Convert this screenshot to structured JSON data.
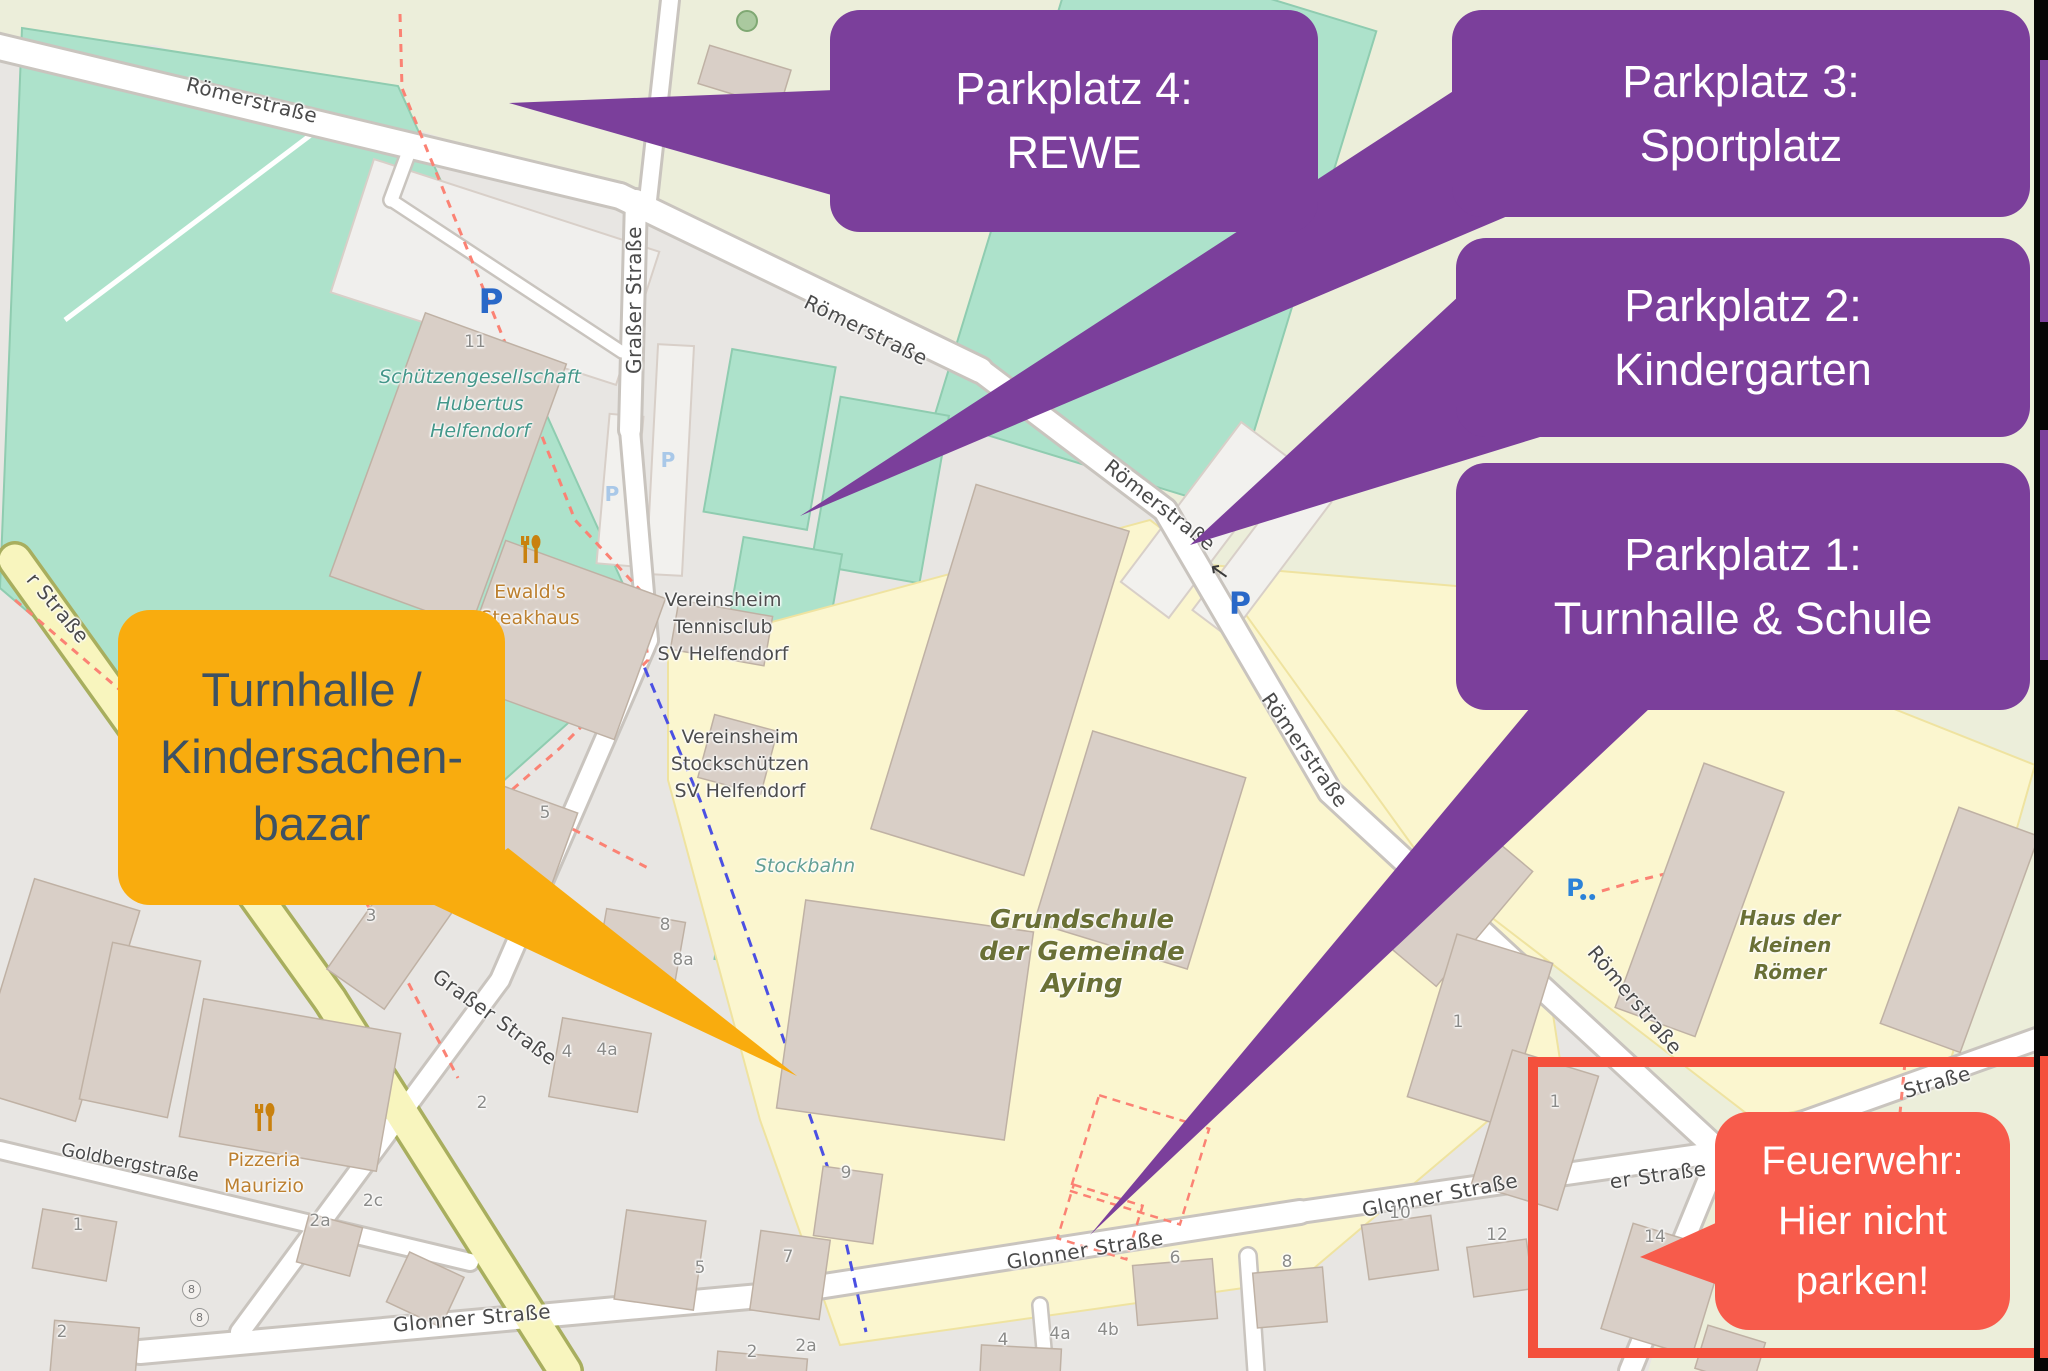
{
  "callouts": {
    "parkplatz4": {
      "lines": [
        "Parkplatz 4:",
        "REWE"
      ]
    },
    "parkplatz3": {
      "lines": [
        "Parkplatz 3:",
        "Sportplatz"
      ]
    },
    "parkplatz2": {
      "lines": [
        "Parkplatz 2:",
        "Kindergarten"
      ]
    },
    "parkplatz1": {
      "lines": [
        "Parkplatz 1:",
        "Turnhalle & Schule"
      ]
    },
    "turnhalle": {
      "lines": [
        "Turnhalle /",
        "Kindersachen-",
        "bazar"
      ]
    },
    "feuerwehr": {
      "lines": [
        "Feuerwehr:",
        "Hier nicht",
        "parken!"
      ]
    }
  },
  "colors": {
    "callout_purple": "#7B3F9B",
    "callout_orange": "#F9AC0E",
    "callout_orange_text": "#3D5163",
    "callout_red": "#F75B4B",
    "warning_box_red": "#F4503C",
    "parking_blue": "#2968C8",
    "parking_pale_blue": "#A9C8E8"
  },
  "map": {
    "streets": {
      "roemerstrasse": "Römerstraße",
      "grasser": "Graßer Straße",
      "goldberg": "Goldbergstraße",
      "glonner": "Glonner Straße",
      "glonner_partial": "er Straße",
      "strasse_partial": "Straße",
      "r_strasse_partial": "r Straße"
    },
    "pois": {
      "schuetzen": [
        "Schützengesellschaft",
        "Hubertus",
        "Helfendorf"
      ],
      "ewald": [
        "Ewald's",
        "Steakhaus"
      ],
      "tennis": [
        "Vereinsheim",
        "Tennisclub",
        "SV Helfendorf"
      ],
      "stockschuetzen": [
        "Vereinsheim",
        "Stockschützen",
        "SV Helfendorf"
      ],
      "stockbahn": "Stockbahn",
      "schule": [
        "Grundschule",
        "der Gemeinde",
        "Aying"
      ],
      "haus": [
        "Haus der",
        "kleinen",
        "Römer"
      ],
      "pizzeria": [
        "Pizzeria",
        "Maurizio"
      ]
    },
    "icons": {
      "parking": "P",
      "one_way_arrow": "↑",
      "restaurant": "fork-and-spoon",
      "bicycle_parking": "P-with-bicycle"
    },
    "numbers": {
      "n1": "1",
      "n2": "2",
      "n2a": "2a",
      "n2c": "2c",
      "n3": "3",
      "n4": "4",
      "n4a": "4a",
      "n4b": "4b",
      "n5": "5",
      "n6": "6",
      "n7": "7",
      "n8": "8",
      "n8a": "8a",
      "n9": "9",
      "n10": "10",
      "n11": "11",
      "n12": "12",
      "n14": "14"
    }
  }
}
